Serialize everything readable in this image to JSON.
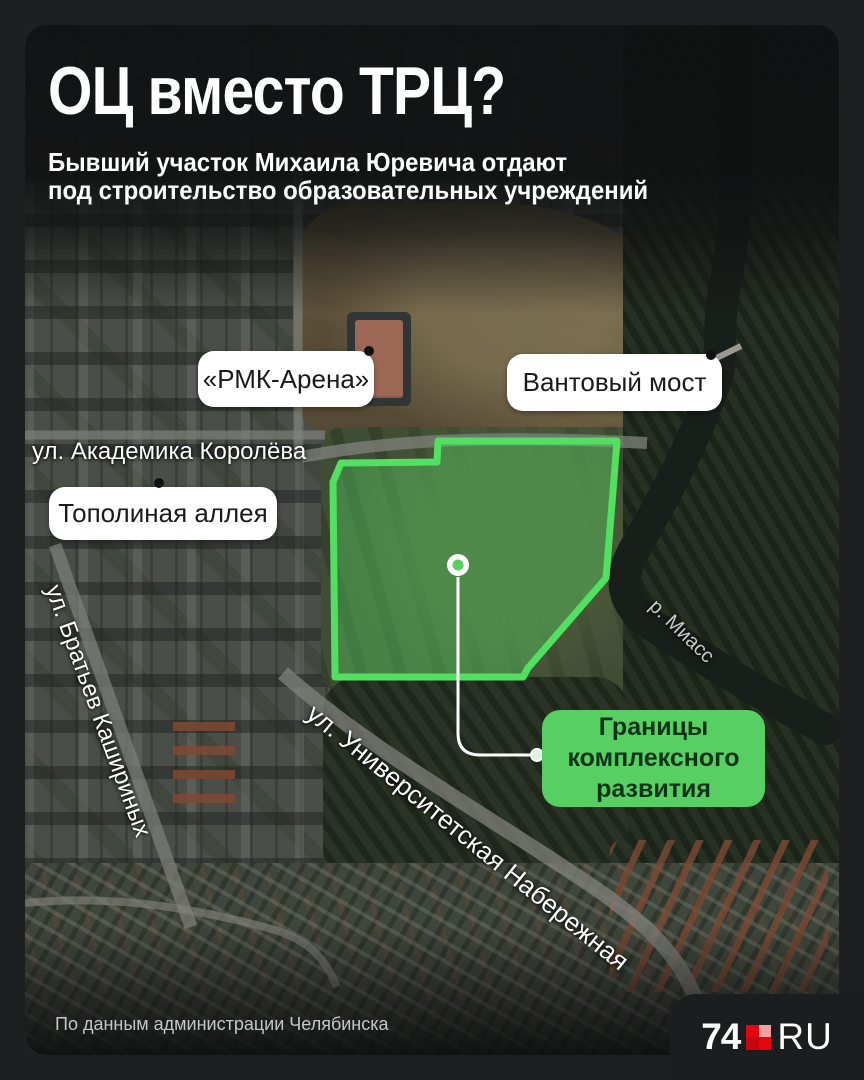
{
  "colors": {
    "background": "#1d1f21",
    "accent_green": "#52e061",
    "area_fill": "rgba(86,217,102,0.38)",
    "label_green": "#57cf63",
    "label_text_dark": "#0e3318",
    "callout_bg": "#ffffff",
    "callout_text": "#1a1a1a",
    "logo_red": "#e20613"
  },
  "header": {
    "title": "ОЦ вместо ТРЦ?",
    "subtitle_line1": "Бывший участок Михаила Юревича отдают",
    "subtitle_line2": "под строительство образовательных учреждений"
  },
  "map": {
    "callouts": [
      {
        "label": "«РМК-Арена»"
      },
      {
        "label": "Вантовый мост"
      },
      {
        "label": "Тополиная аллея"
      }
    ],
    "streets": {
      "koroleva": "ул. Академика Королёва",
      "kashirinykh": "ул. Братьев Кашириных",
      "universitetskaya": "ул. Университетская Набережная",
      "miass": "р. Миасс"
    },
    "area_label": {
      "line1": "Границы",
      "line2": "комплексного",
      "line3": "развития"
    }
  },
  "footer": {
    "attribution": "По данным администрации Челябинска",
    "logo": {
      "prefix": "74",
      "suffix": "RU"
    }
  }
}
